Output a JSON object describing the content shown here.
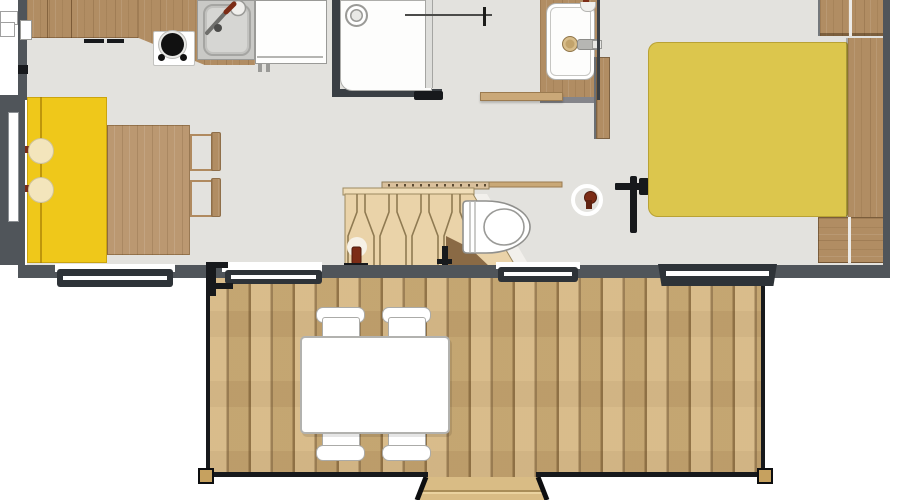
{
  "palette": {
    "outside": "#ffffff",
    "floor": "#e3e2de",
    "wall": "#50555a",
    "wall_dark": "#3a3f44",
    "window_frame": "#2e3338",
    "glass": "#ffffff",
    "wood": "#b18d63",
    "wood_dark": "#8f6f4a",
    "wood_table": "#bb9871",
    "deck_plank": "#d3b27a",
    "rack_tan": "#ead3a9",
    "rack_line": "#8f7a52",
    "sofa_yellow": "#efc81a",
    "bed_yellow": "#dcc64d",
    "cushion_cream": "#f3e5bc",
    "accent_dark_red": "#7c2c16",
    "fixture_white": "#fdfdfc",
    "fixture_border": "#a8a8a5",
    "black": "#17191c"
  },
  "floorplan": {
    "type": "mobile-home floor plan, top view, no text labels",
    "rooms": [
      {
        "name": "kitchen-living-area"
      },
      {
        "name": "shower-room"
      },
      {
        "name": "bathroom-vanity"
      },
      {
        "name": "bedroom"
      },
      {
        "name": "deck-terrace"
      }
    ],
    "furniture": [
      "kitchen-counter",
      "gas-hob",
      "kitchen-sink",
      "fridge",
      "shower-tray",
      "shower-screen",
      "washbasin-vanity",
      "wall-shelf",
      "toilet",
      "interior-door",
      "folded-chairs-rack",
      "sofa",
      "sofa-cushions",
      "dining-table",
      "dining-chairs",
      "double-bed",
      "headboard",
      "wardrobe",
      "nightstands",
      "sliding-door",
      "window",
      "deck-boards",
      "outdoor-table",
      "outdoor-chairs",
      "deck-steps",
      "deck-posts"
    ]
  }
}
